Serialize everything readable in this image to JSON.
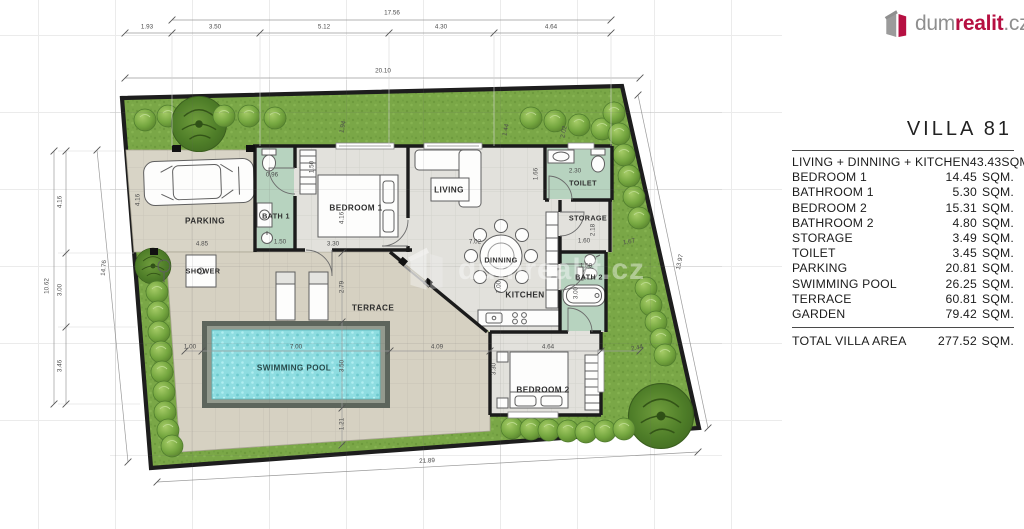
{
  "logo": {
    "prefix": "dum",
    "brand": "realit",
    "suffix": ".cz"
  },
  "watermark": "dumrealit.cz",
  "legend": {
    "title": "VILLA  81",
    "unit": "SQM.",
    "rows": [
      {
        "label": "LIVING + DINNING + KITCHEN",
        "area": "43.43"
      },
      {
        "label": "BEDROOM  1",
        "area": "14.45"
      },
      {
        "label": "BATHROOM  1",
        "area": "5.30"
      },
      {
        "label": "BEDROOM  2",
        "area": "15.31"
      },
      {
        "label": "BATHROOM  2",
        "area": "4.80"
      },
      {
        "label": "STORAGE",
        "area": "3.49"
      },
      {
        "label": "TOILET",
        "area": "3.45"
      },
      {
        "label": "PARKING",
        "area": "20.81"
      },
      {
        "label": "SWIMMING POOL",
        "area": "26.25"
      },
      {
        "label": "TERRACE",
        "area": "60.81"
      },
      {
        "label": "GARDEN",
        "area": "79.42"
      }
    ],
    "total_label": "TOTAL  VILLA  AREA",
    "total_area": "277.52"
  },
  "plan": {
    "room_labels": [
      {
        "id": "parking",
        "text": "PARKING",
        "x": 205,
        "y": 221
      },
      {
        "id": "bath-1",
        "text": "BATH 1",
        "x": 276,
        "y": 216,
        "small": true
      },
      {
        "id": "bedroom-1",
        "text": "BEDROOM 1",
        "x": 356,
        "y": 208
      },
      {
        "id": "living",
        "text": "LIVING",
        "x": 449,
        "y": 190
      },
      {
        "id": "toilet",
        "text": "TOILET",
        "x": 583,
        "y": 183,
        "small": true
      },
      {
        "id": "storage",
        "text": "STORAGE",
        "x": 588,
        "y": 218,
        "small": true
      },
      {
        "id": "dinning",
        "text": "DINNING",
        "x": 501,
        "y": 260,
        "small": true
      },
      {
        "id": "kitchen",
        "text": "KITCHEN",
        "x": 525,
        "y": 295
      },
      {
        "id": "bath-2",
        "text": "BATH 2",
        "x": 589,
        "y": 277,
        "small": true
      },
      {
        "id": "shower",
        "text": "SHOWER",
        "x": 203,
        "y": 271,
        "small": true
      },
      {
        "id": "terrace",
        "text": "TERRACE",
        "x": 373,
        "y": 308
      },
      {
        "id": "swimming-pool",
        "text": "SWIMMING POOL",
        "x": 294,
        "y": 368,
        "pool": true
      },
      {
        "id": "bedroom-2",
        "text": "BEDROOM 2",
        "x": 543,
        "y": 390
      }
    ],
    "dimensions": [
      {
        "t": "17.56",
        "x": 392,
        "y": 13
      },
      {
        "t": "1.93",
        "x": 147,
        "y": 27
      },
      {
        "t": "3.50",
        "x": 215,
        "y": 27
      },
      {
        "t": "5.12",
        "x": 324,
        "y": 27
      },
      {
        "t": "4.30",
        "x": 441,
        "y": 27
      },
      {
        "t": "4.64",
        "x": 551,
        "y": 27
      },
      {
        "t": "20.10",
        "x": 383,
        "y": 71
      },
      {
        "t": "10.62",
        "x": 47,
        "y": 286,
        "r": -90
      },
      {
        "t": "4.16",
        "x": 60,
        "y": 202,
        "r": -90
      },
      {
        "t": "3.00",
        "x": 60,
        "y": 290,
        "r": -90
      },
      {
        "t": "3.46",
        "x": 60,
        "y": 366,
        "r": -90
      },
      {
        "t": "14.76",
        "x": 104,
        "y": 268,
        "r": -85
      },
      {
        "t": "13.97",
        "x": 680,
        "y": 262,
        "r": -78
      },
      {
        "t": "21.89",
        "x": 427,
        "y": 461,
        "r": -3
      },
      {
        "t": "4.16",
        "x": 138,
        "y": 200,
        "r": -90
      },
      {
        "t": "4.85",
        "x": 202,
        "y": 244
      },
      {
        "t": "0.96",
        "x": 272,
        "y": 175
      },
      {
        "t": "1.50",
        "x": 312,
        "y": 167,
        "r": -90
      },
      {
        "t": "1.50",
        "x": 280,
        "y": 242
      },
      {
        "t": "3.30",
        "x": 333,
        "y": 244
      },
      {
        "t": "4.16",
        "x": 342,
        "y": 218,
        "r": -90
      },
      {
        "t": "1.94",
        "x": 343,
        "y": 127,
        "r": -78
      },
      {
        "t": "1.44",
        "x": 506,
        "y": 130,
        "r": -78
      },
      {
        "t": "2.02",
        "x": 564,
        "y": 132,
        "r": -78
      },
      {
        "t": "1.66",
        "x": 536,
        "y": 174,
        "r": -90
      },
      {
        "t": "2.30",
        "x": 575,
        "y": 171
      },
      {
        "t": "2.18",
        "x": 593,
        "y": 230,
        "r": -90
      },
      {
        "t": "1.60",
        "x": 584,
        "y": 241
      },
      {
        "t": "1.50",
        "x": 586,
        "y": 266
      },
      {
        "t": "3.00",
        "x": 576,
        "y": 293,
        "r": -90
      },
      {
        "t": "7.02",
        "x": 475,
        "y": 242
      },
      {
        "t": "7.00",
        "x": 499,
        "y": 287,
        "r": -90
      },
      {
        "t": "2.79",
        "x": 342,
        "y": 287,
        "r": -90
      },
      {
        "t": "1.00",
        "x": 190,
        "y": 347
      },
      {
        "t": "7.00",
        "x": 296,
        "y": 347
      },
      {
        "t": "3.50",
        "x": 342,
        "y": 366,
        "r": -90
      },
      {
        "t": "4.09",
        "x": 437,
        "y": 347
      },
      {
        "t": "4.64",
        "x": 548,
        "y": 347
      },
      {
        "t": "3.30",
        "x": 494,
        "y": 369,
        "r": -90
      },
      {
        "t": "2.44",
        "x": 637,
        "y": 348,
        "r": -12
      },
      {
        "t": "1.67",
        "x": 629,
        "y": 242,
        "r": -10
      },
      {
        "t": "1.21",
        "x": 342,
        "y": 424,
        "r": -90
      }
    ]
  }
}
